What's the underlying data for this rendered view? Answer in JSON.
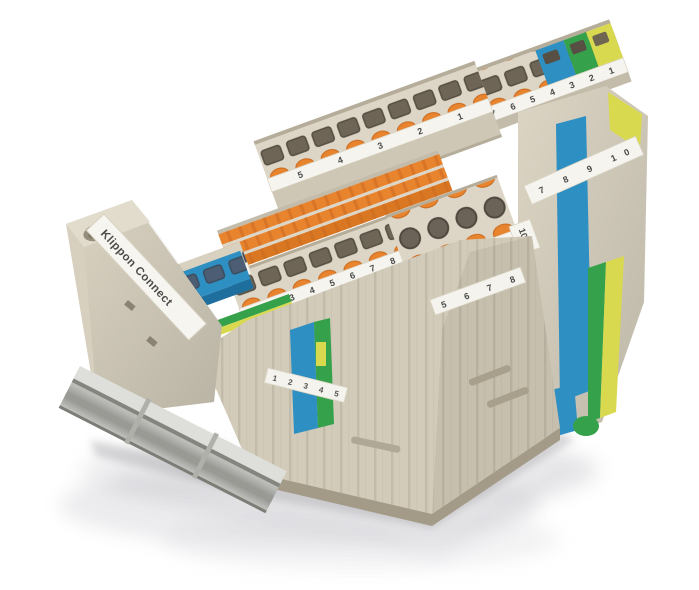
{
  "image": {
    "type": "product-photograph",
    "subject": "DIN-rail terminal block assembly, angled view on white studio background with soft reflection"
  },
  "branding": {
    "rail_label": "Klippon Connect"
  },
  "marking_strips": {
    "top_row": "10 9 8 7 6 5 4 3 2 1",
    "back_row": "5 4 3 2 1",
    "mid_row": "1 2 3 4 5 6 7 8 9 10",
    "left_step": "1 2 3 4 5",
    "center_front": "1 2 3 4 5",
    "right_top": "6 7 8 9",
    "right_front": "5 6 7 8",
    "end_plate": "7 8 9 10",
    "group_marker": "10"
  },
  "colors": {
    "housing": "#dcd5c4",
    "housing_mid": "#cfc7b5",
    "housing_dark": "#b5ad9a",
    "orange": "#e8832e",
    "orange_dark": "#cf6d1f",
    "port": "#6e6557",
    "blue": "#2e8fc2",
    "blue_dark": "#1f6f9e",
    "green": "#36a14b",
    "yellow": "#d8d94f",
    "strip_white": "#f5f4ef",
    "rail_silver": "#c6c6c2",
    "text": "#4a4a4a"
  }
}
